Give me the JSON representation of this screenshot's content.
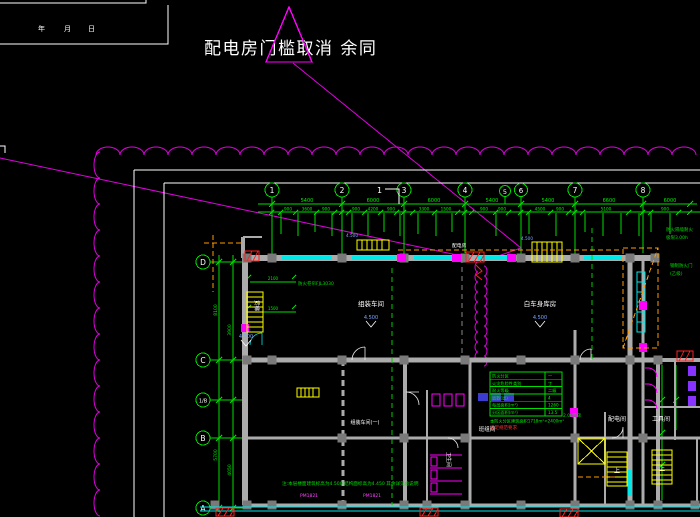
{
  "annotation": {
    "title": "配电房门槛取消 余同",
    "marker": "1"
  },
  "titleblock": {
    "f1": "年",
    "f2": "月",
    "f3": "日"
  },
  "axes": {
    "top": [
      "1",
      "2",
      "3",
      "4",
      "5",
      "6",
      "7",
      "8"
    ],
    "left": [
      "D",
      "C",
      "1/B",
      "B",
      "A"
    ]
  },
  "dims": {
    "top_main": [
      "5400",
      "6000",
      "6000",
      "5400",
      "5400",
      "6600",
      "6000"
    ],
    "top_sub": [
      "900",
      "3600",
      "900",
      "900",
      "4200",
      "900",
      "3300",
      "1500",
      "900",
      "900",
      "4500",
      "900",
      "5100",
      "900"
    ],
    "left_main": [
      "8100",
      "3900",
      "5700",
      "4050"
    ],
    "inner": [
      "2100",
      "1500"
    ]
  },
  "rooms": {
    "r1": "组装车间",
    "r2": "白车身库房",
    "r3": "配电间",
    "r4": "工具间",
    "r5": "组装车间(一)",
    "r6": "班组间",
    "r7": "货梯",
    "r8": "卫生间"
  },
  "levels": {
    "v": "4.500"
  },
  "tags": {
    "pm": "PM1821",
    "shutter": "防火卷帘FJL3030",
    "fire_wall_1": "防火隔墙耐火",
    "fire_wall_2": "极限3.00h",
    "fire_door_1": "钢制防火门",
    "fire_door_2": "(乙级)",
    "lift": "2.0t货梯",
    "up": "上",
    "room_note": "配电房"
  },
  "schedule": {
    "rows": [
      [
        "防火分区",
        "一"
      ],
      [
        "火灾危险性类别",
        "丁"
      ],
      [
        "耐火等级",
        "二级"
      ],
      [
        "层数(层)",
        "4"
      ],
      [
        "每层面积(m²)",
        "1260"
      ],
      [
        "分区面积(m²)",
        "13.5"
      ]
    ],
    "note_green": "本防火分区建筑面积1718m²<2400m²",
    "note_red": "满足规范要求"
  },
  "bottom_note": "注:本层楼面建筑标高为4.500 结构面标高为4.450 其余详见总说明"
}
